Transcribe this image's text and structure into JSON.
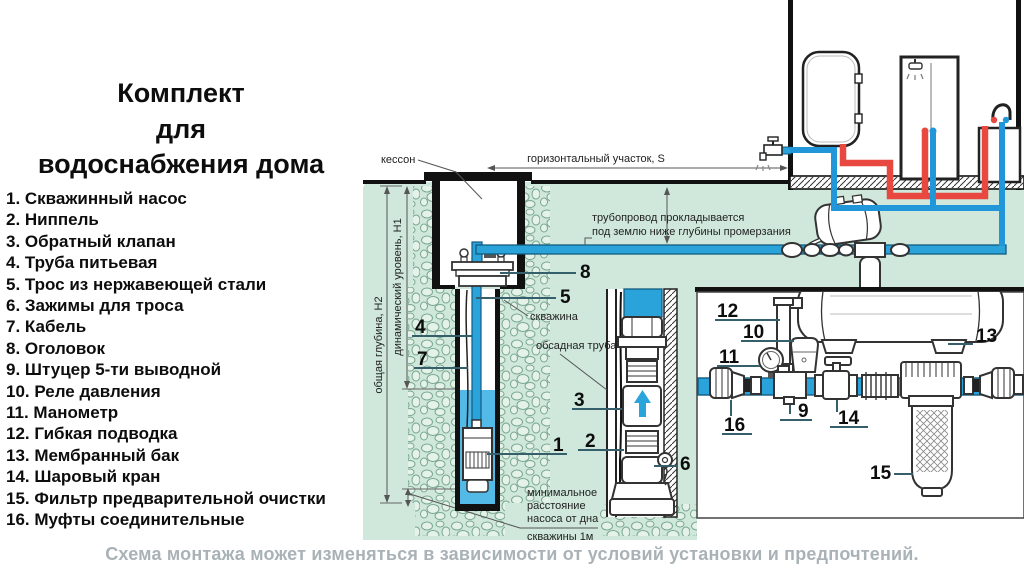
{
  "title": {
    "line1": "Комплект",
    "line2": "для",
    "line3": "водоснабжения дома"
  },
  "parts": [
    "1. Скважинный насос",
    "2. Ниппель",
    "3. Обратный клапан",
    "4. Труба питьевая",
    "5. Трос из нержавеющей стали",
    "6. Зажимы для троса",
    "7. Кабель",
    "8. Оголовок",
    "9. Штуцер 5-ти выводной",
    "10. Реле давления",
    "11. Манометр",
    "12. Гибкая подводка",
    "13. Мембранный бак",
    "14. Шаровый кран",
    "15. Фильтр предварительной очистки",
    "16. Муфты соединительные"
  ],
  "caption": "Схема монтажа может изменяться в зависимости от условий установки и предпочтений.",
  "diagram": {
    "labels": {
      "caisson": "кессон",
      "horizontal_section": "горизонтальный участок, S",
      "pipeline_line1": "трубопровод прокладывается",
      "pipeline_line2": "под землю ниже глубины промерзания",
      "well": "скважина",
      "casing": "обсадная труба",
      "total_depth": "общая глубина, Н2",
      "dynamic_level": "динамический уровень, Н1",
      "min_dist_line1": "минимальное",
      "min_dist_line2": "расстояние",
      "min_dist_line3": "насоса от дна",
      "min_dist_line4": "скважины 1м"
    },
    "markers": {
      "m1": "1",
      "m2": "2",
      "m3": "3",
      "m4": "4",
      "m5": "5",
      "m6": "6",
      "m7": "7",
      "m8": "8",
      "m9": "9",
      "m10": "10",
      "m11": "11",
      "m12": "12",
      "m13": "13",
      "m14": "14",
      "m15": "15",
      "m16": "16"
    },
    "colors": {
      "ground_green": "#cfe8db",
      "pipe_blue": "#2aa3da",
      "pipe_blue_dark": "#135a80",
      "pipe_red": "#e84840",
      "stone_outline": "#7aa78e",
      "caption_gray": "#a9b2b6"
    }
  }
}
